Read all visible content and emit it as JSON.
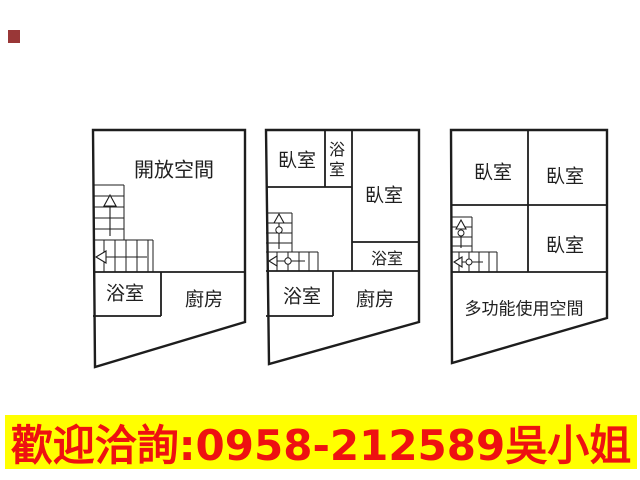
{
  "marker": {
    "color": "#993737"
  },
  "floorplans": {
    "line_color": "#1d1d1d",
    "plan1": {
      "open_space": "開放空間",
      "bathroom": "浴室",
      "kitchen": "廚房"
    },
    "plan2": {
      "bedroom_top": "臥室",
      "bathroom_top": "浴室",
      "bedroom_right": "臥室",
      "bathroom_right": "浴室",
      "bathroom_left": "浴室",
      "kitchen": "廚房"
    },
    "plan3": {
      "bedroom_top_left": "臥室",
      "bedroom_top_right": "臥室",
      "bedroom_right": "臥室",
      "multipurpose": "多功能使用空間"
    }
  },
  "banner": {
    "text": "歡迎洽詢:0958-212589吳小姐",
    "background": "#ffff00",
    "text_color": "#ee1111"
  }
}
